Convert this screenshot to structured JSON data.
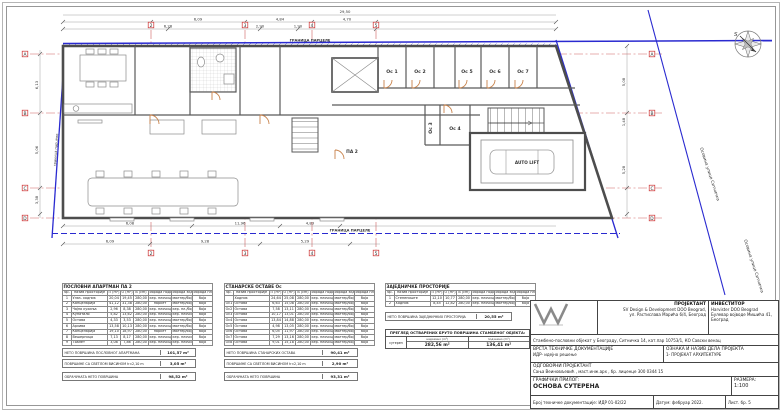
{
  "plan": {
    "grid_cols": [
      "2",
      "3",
      "4",
      "5"
    ],
    "grid_rows": [
      "A",
      "B",
      "C",
      "D"
    ],
    "boundary": {
      "top_label": "ГРАНИЦА ПАРЦЕЛЕ",
      "bottom_label": "ГРАНИЦА ПАРЦЕЛЕ",
      "left_label": "граница парцеле",
      "street_axis_label": "Осовина улице Ситничка"
    },
    "compass_letter": "S",
    "rooms": {
      "oc1": "Ос 1",
      "oc2": "Ос 2",
      "oc3": "Ос 3",
      "oc4": "Ос 4",
      "oc5": "Ос 5",
      "oc6": "Ос 6",
      "oc7": "Ос 7",
      "auto_lift": "AUTO LIFT",
      "pa2": "ПА 2"
    },
    "dims": {
      "t1": "29,50",
      "t2a": "6,09",
      "t2b": "4,84",
      "t2c": "4,70",
      "t3a": "6,28",
      "t3b": "2,90",
      "t3c": "1,90",
      "b1": "6,08",
      "b2": "11,96",
      "b3": "4,83",
      "b4": "6,09",
      "b5": "9,28",
      "b6": "5,29",
      "b7": "11,10",
      "b8": "6,51",
      "a1": "5,50",
      "a2": "3,40",
      "r1": "5,08",
      "r2": "1,48",
      "r3": "5,28",
      "l1": "6,13",
      "l2": "5,06",
      "l3": "3,38"
    }
  },
  "schedules": {
    "t1": {
      "title": "ПОСЛОВНИ АПАРТМАН ПА 2",
      "headers": [
        "бр.",
        "назив просторије",
        "П (m²)",
        "О (m¹)",
        "В (cm)",
        "обрада пода",
        "обрада зидова",
        "обрада плафона"
      ],
      "rows": [
        [
          "1",
          "Улаз- ходник",
          "20,04",
          "19,45",
          "280,00",
          "кер. плочице",
          "малтер/боја",
          "боја"
        ],
        [
          "2",
          "Канцеларија",
          "41,12",
          "31,38",
          "280,00",
          "паркет",
          "малтер/боја",
          "боја"
        ],
        [
          "3",
          "Чајна кухиња",
          "2,96",
          "8,38",
          "280,00",
          "кер. плочице",
          "кер. пл./боја",
          "боја"
        ],
        [
          "4",
          "Купатило",
          "5,82",
          "13,62",
          "280,00",
          "кер. плочице",
          "кер. плочице",
          "боја"
        ],
        [
          "5",
          "Остава",
          "4,33",
          "3,53",
          "280,00",
          "кер. плочице",
          "малтер/боја",
          "боја"
        ],
        [
          "6",
          "Архива",
          "13,58",
          "10,13",
          "280,00",
          "кер. плочице",
          "малтер/боја",
          "боја"
        ],
        [
          "7",
          "Канцеларија",
          "19,10",
          "18,97",
          "280,00",
          "паркет",
          "малтер/боја",
          "боја"
        ],
        [
          "8",
          "Вешерница",
          "7,13",
          "8,17",
          "280,00",
          "кер. плочице",
          "кер. плочице",
          "боја"
        ],
        [
          "9",
          "Тоалет",
          "3,08",
          "7,86",
          "280,00",
          "кер. плочице",
          "кер. плочице",
          "боја"
        ]
      ],
      "summaries": [
        {
          "label": "НЕТО ПОВРШИНА ПОСЛОВНОГ АПАРТМАНА",
          "value": "101,57 m²"
        },
        {
          "label": "ПОВРШИНЕ СА СВЕТЛОМ ВИСИНОМ h<2,10 m",
          "value": "3,05 m²"
        },
        {
          "label": "ОБРАЧУНАТА НЕТО ПОВРШИНА",
          "value": "98,52 m²"
        }
      ]
    },
    "t2": {
      "title": "СТАНАРСКЕ ОСТАВЕ Ос",
      "headers": [
        "бр.",
        "назив просторије",
        "П (m²)",
        "О (m¹)",
        "В (cm)",
        "обрада пода",
        "обрада зидова",
        "обрада плафона"
      ],
      "rows": [
        [
          "",
          "Ходник",
          "24,64",
          "25,08",
          "280,00",
          "кер. плочице",
          "малтер/боја",
          "боја"
        ],
        [
          "Ос1",
          "Остава",
          "6,63",
          "15,08",
          "280,00",
          "кер. плочице",
          "малтер/боја",
          "боја"
        ],
        [
          "Ос2",
          "Остава",
          "7,58",
          "13,11",
          "280,00",
          "кер. плочице",
          "малтер/боја",
          "боја"
        ],
        [
          "Ос3",
          "Остава",
          "10,17",
          "13,01",
          "280,00",
          "кер. плочице",
          "малтер/боја",
          "боја"
        ],
        [
          "Ос4",
          "Остава",
          "13,84",
          "14,88",
          "280,00",
          "кер. плочице",
          "малтер/боја",
          "боја"
        ],
        [
          "Ос5",
          "Остава",
          "4,98",
          "13,05",
          "280,00",
          "кер. плочице",
          "малтер/боја",
          "боја"
        ],
        [
          "Ос6",
          "Остава",
          "6,05",
          "11,97",
          "280,00",
          "кер. плочице",
          "малтер/боја",
          "боја"
        ],
        [
          "Ос7",
          "Остава",
          "7,29",
          "13,16",
          "280,00",
          "кер. плочице",
          "малтер/боја",
          "боја"
        ],
        [
          "Ос8",
          "Остава",
          "9,01",
          "15,18",
          "280,00",
          "кер. плочице",
          "малтер/боја",
          "боја"
        ]
      ],
      "summaries": [
        {
          "label": "НЕТО ПОВРШИНА СТАНАРСКИХ ОСТАВА",
          "value": "90,41 m²"
        },
        {
          "label": "ПОВРШИНЕ СА СВЕТЛОМ ВИСИНОМ h<2,10 m",
          "value": "2,90 m²"
        },
        {
          "label": "ОБРАЧУНАТА НЕТО ПОВРШИНА",
          "value": "93,31 m²"
        }
      ]
    },
    "t3": {
      "title": "ЗАЈЕДНИЧКЕ ПРОСТОРИЈЕ",
      "headers": [
        "бр.",
        "назив просторије",
        "П (m²)",
        "О (m¹)",
        "В (cm)",
        "обрада пода",
        "обрада зидова",
        "обрада плафона"
      ],
      "rows": [
        [
          "1",
          "Степениште",
          "12,10",
          "10,77",
          "280,00",
          "кер. плочице",
          "малтер/боја",
          "боја"
        ],
        [
          "2",
          "Ходник",
          "8,45",
          "12,82",
          "280,00",
          "кер. плочице",
          "малтер/боја",
          "боја"
        ]
      ],
      "summary": {
        "label": "НЕТО ПОВРШИНА ЗАЈЕДНИЧКИХ ПРОСТОРИЈА",
        "value": "20,55 m²"
      }
    },
    "t4": {
      "title": "ПРЕГЛЕД ОСТВАРЕНИХ БРУТО ПОВРШИНА СТАМБЕНОГ ОБЈЕКТА:",
      "row_label": "сутерен",
      "col1_header": "надземно (m²)",
      "col1_value": "282,56 m²",
      "col2_header": "подземно (m²)",
      "col2_value": "136,41 m²"
    }
  },
  "titleblock": {
    "projektant_label": "ПРОЈЕКТАНТ",
    "projektant_name": "SV Design & Development DOO Beograd,",
    "projektant_addr": "ул. Растислава Марића 6/4, Београд",
    "investitor_label": "ИНВЕСТИТОР",
    "investitor_name": "Harvister DOO Beograd",
    "investitor_addr": "Булевар војводе Мишића 41, Београд",
    "object_line": "Стамбено-пословни објекат у Београду, Ситничка 14, кат.пар 10753/1, КО Савски венац",
    "doc_type_label": "ВРСТА ТЕХНИЧКЕ ДОКУМЕНТАЦИЈЕ",
    "doc_type_value": "ИДР- идејно решење",
    "part_label": "ОЗНАКА И НАЗИВ ДЕЛА ПРОЈЕКТА",
    "part_value": "1- ПРОЈЕКАТ АРХИТЕКТУРЕ",
    "resp_label": "ОДГОВОРНИ ПРОЈЕКТАНТ",
    "resp_value": "Сања Веиновљевић , маст.инж.арх ,  бр. лиценце 300 0344 15",
    "graphic_label": "ГРАФИЧКИ ПРИЛОГ:",
    "graphic_value": "ОСНОВА СУТЕРЕНА",
    "scale_label": "РАЗМЕРА:",
    "scale_value": "1:100",
    "doc_num": "Број техничке документације: ИДР 01-02/22",
    "date": "Датум: фебруар 2022.",
    "sheet_num": "Лист. бр. 5"
  }
}
